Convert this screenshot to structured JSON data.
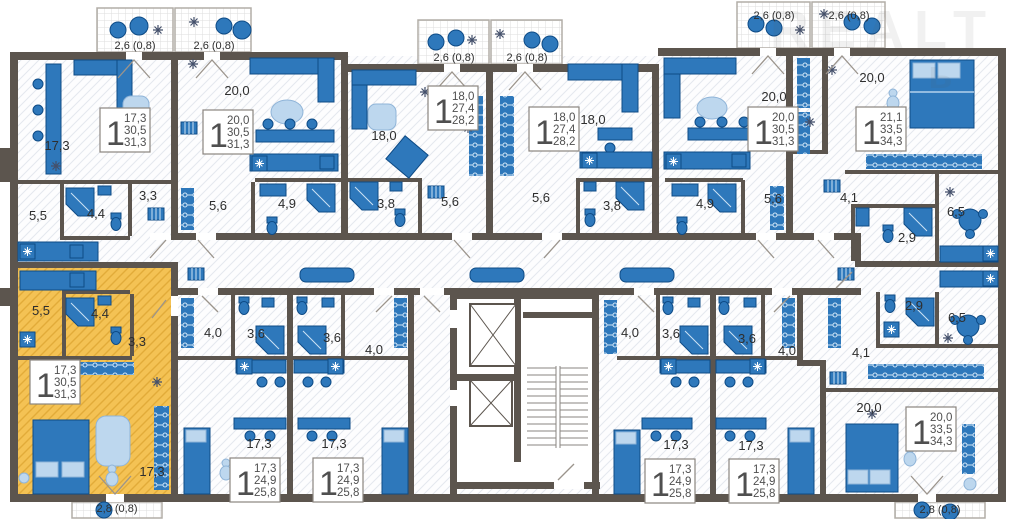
{
  "plan": {
    "watermark": {
      "line1": "REALT",
      "line2": "ь"
    },
    "colors": {
      "wall": "#5c554e",
      "furniture": "#2e78bb",
      "highlight": "#f3c050",
      "rug": "#bdd7ee"
    },
    "balconies": [
      {
        "id": "b1",
        "label": "2,6 (0,8)"
      },
      {
        "id": "b2",
        "label": "2,6 (0,8)"
      },
      {
        "id": "b3",
        "label": "2,6 (0,8)"
      },
      {
        "id": "b4",
        "label": "2,6 (0,8)"
      },
      {
        "id": "b5",
        "label": "2,6 (0,8)"
      },
      {
        "id": "b6",
        "label": "2,6 (0,8)"
      },
      {
        "id": "b7",
        "label": "2,8 (0,8)"
      },
      {
        "id": "b8",
        "label": "2,8 (0,8)"
      }
    ],
    "apartments": [
      {
        "id": "top-left",
        "type": "1",
        "living_area": "17,3",
        "area": "30,5",
        "total_area": "31,3",
        "rooms": [
          "17,3",
          "5,5",
          "4,4",
          "3,3"
        ],
        "highlighted": false
      },
      {
        "id": "top-2",
        "type": "1",
        "living_area": "20,0",
        "area": "30,5",
        "total_area": "31,3",
        "rooms": [
          "20,0",
          "5,6",
          "4,9"
        ],
        "highlighted": false
      },
      {
        "id": "top-3",
        "type": "1",
        "living_area": "18,0",
        "area": "27,4",
        "total_area": "28,2",
        "rooms": [
          "18,0",
          "3,8",
          "5,6"
        ],
        "highlighted": false
      },
      {
        "id": "top-4",
        "type": "1",
        "living_area": "18,0",
        "area": "27,4",
        "total_area": "28,2",
        "rooms": [
          "18,0",
          "5,6",
          "3,8"
        ],
        "highlighted": false
      },
      {
        "id": "top-5",
        "type": "1",
        "living_area": "20,0",
        "area": "30,5",
        "total_area": "31,3",
        "rooms": [
          "20,0",
          "4,9",
          "5,6"
        ],
        "highlighted": false
      },
      {
        "id": "top-right",
        "type": "1",
        "living_area": "21,1",
        "area": "33,5",
        "total_area": "34,3",
        "rooms": [
          "20,0",
          "4,1",
          "2,9",
          "6,5"
        ],
        "highlighted": false
      },
      {
        "id": "bottom-left",
        "type": "1",
        "living_area": "17,3",
        "area": "30,5",
        "total_area": "31,3",
        "rooms": [
          "5,5",
          "4,4",
          "3,3",
          "17,3"
        ],
        "highlighted": true
      },
      {
        "id": "bottom-2",
        "type": "1",
        "living_area": "17,3",
        "area": "24,9",
        "total_area": "25,8",
        "rooms": [
          "4,0",
          "3,6",
          "17,3"
        ],
        "highlighted": false
      },
      {
        "id": "bottom-3",
        "type": "1",
        "living_area": "17,3",
        "area": "24,9",
        "total_area": "25,8",
        "rooms": [
          "3,6",
          "4,0",
          "17,3"
        ],
        "highlighted": false
      },
      {
        "id": "bottom-4",
        "type": "1",
        "living_area": "17,3",
        "area": "24,9",
        "total_area": "25,8",
        "rooms": [
          "4,0",
          "3,6",
          "17,3"
        ],
        "highlighted": false
      },
      {
        "id": "bottom-5",
        "type": "1",
        "living_area": "17,3",
        "area": "24,9",
        "total_area": "25,8",
        "rooms": [
          "3,6",
          "4,0",
          "17,3"
        ],
        "highlighted": false
      },
      {
        "id": "bottom-right",
        "type": "1",
        "living_area": "20,0",
        "area": "33,5",
        "total_area": "34,3",
        "rooms": [
          "2,9",
          "6,5",
          "4,1",
          "20,0"
        ],
        "highlighted": false
      }
    ]
  }
}
